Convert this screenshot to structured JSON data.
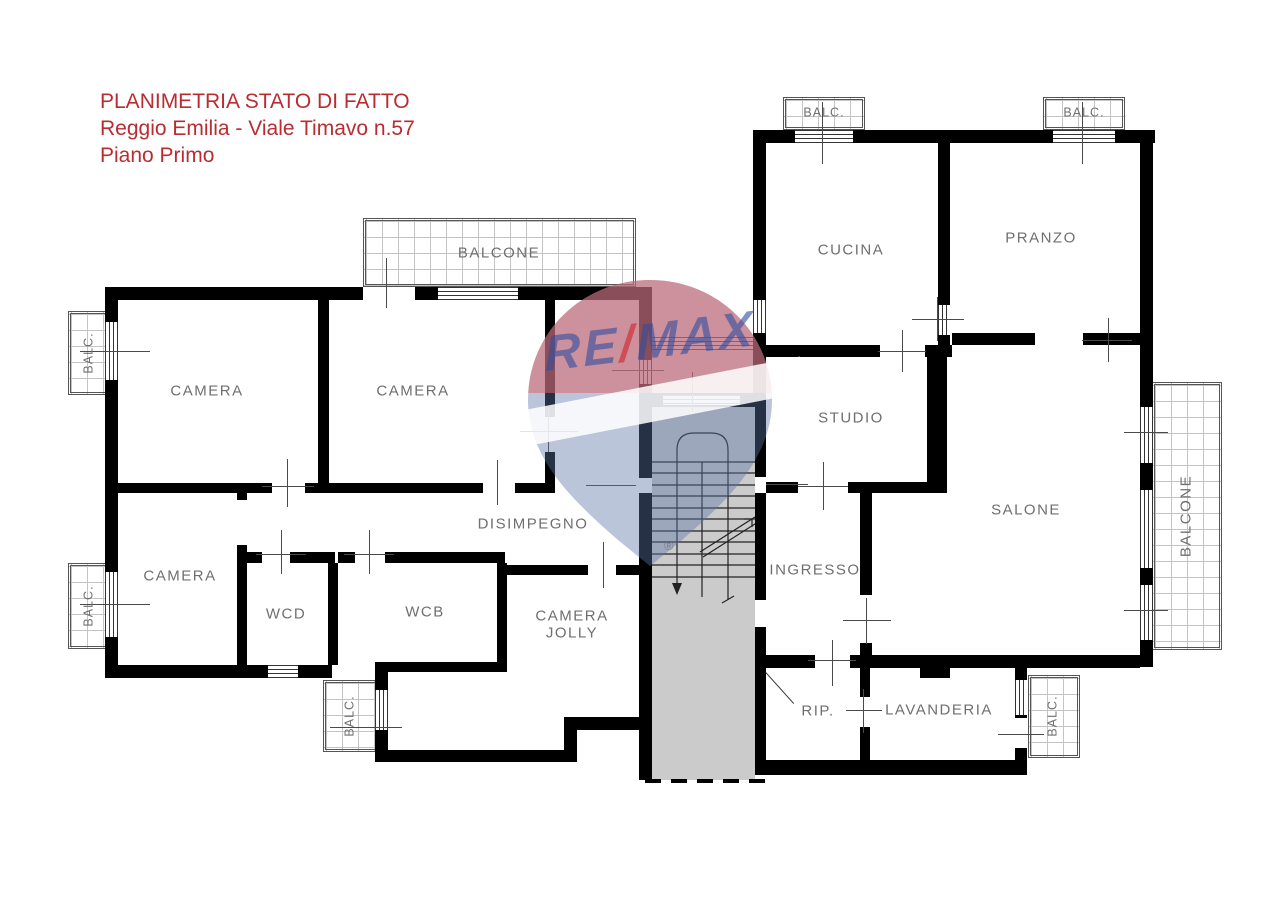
{
  "title": {
    "line1": "PLANIMETRIA STATO DI FATTO",
    "line2": "Reggio Emilia - Viale Timavo n.57",
    "line3": "Piano Primo"
  },
  "rooms": {
    "camera1": "CAMERA",
    "camera2": "CAMERA",
    "camera3": "CAMERA",
    "wcd": "WCD",
    "wcb": "WCB",
    "disimpegno": "DISIMPEGNO",
    "camera_jolly_line1": "CAMERA",
    "camera_jolly_line2": "JOLLY",
    "cucina": "CUCINA",
    "pranzo": "PRANZO",
    "studio": "STUDIO",
    "salone": "SALONE",
    "ingresso": "INGRESSO",
    "rip": "RIP.",
    "lavanderia": "LAVANDERIA"
  },
  "balconies": {
    "balcone_top": "BALCONE",
    "balcone_right": "BALCONE",
    "balc_left_upper": "BALC.",
    "balc_left_lower": "BALC.",
    "balc_bottom_left": "BALC.",
    "balc_top_1": "BALC.",
    "balc_top_2": "BALC.",
    "balc_bottom_right": "BALC."
  },
  "watermark": {
    "re": "RE",
    "slash": "/",
    "max": "MAX",
    "registered": "®"
  },
  "colors": {
    "wall": "#000000",
    "title_red": "#b92c31",
    "label_gray": "#6f6f6f",
    "stair_gray": "#cbcbcb",
    "watermark_blue": "#5d74a6",
    "watermark_red": "#db666c"
  }
}
